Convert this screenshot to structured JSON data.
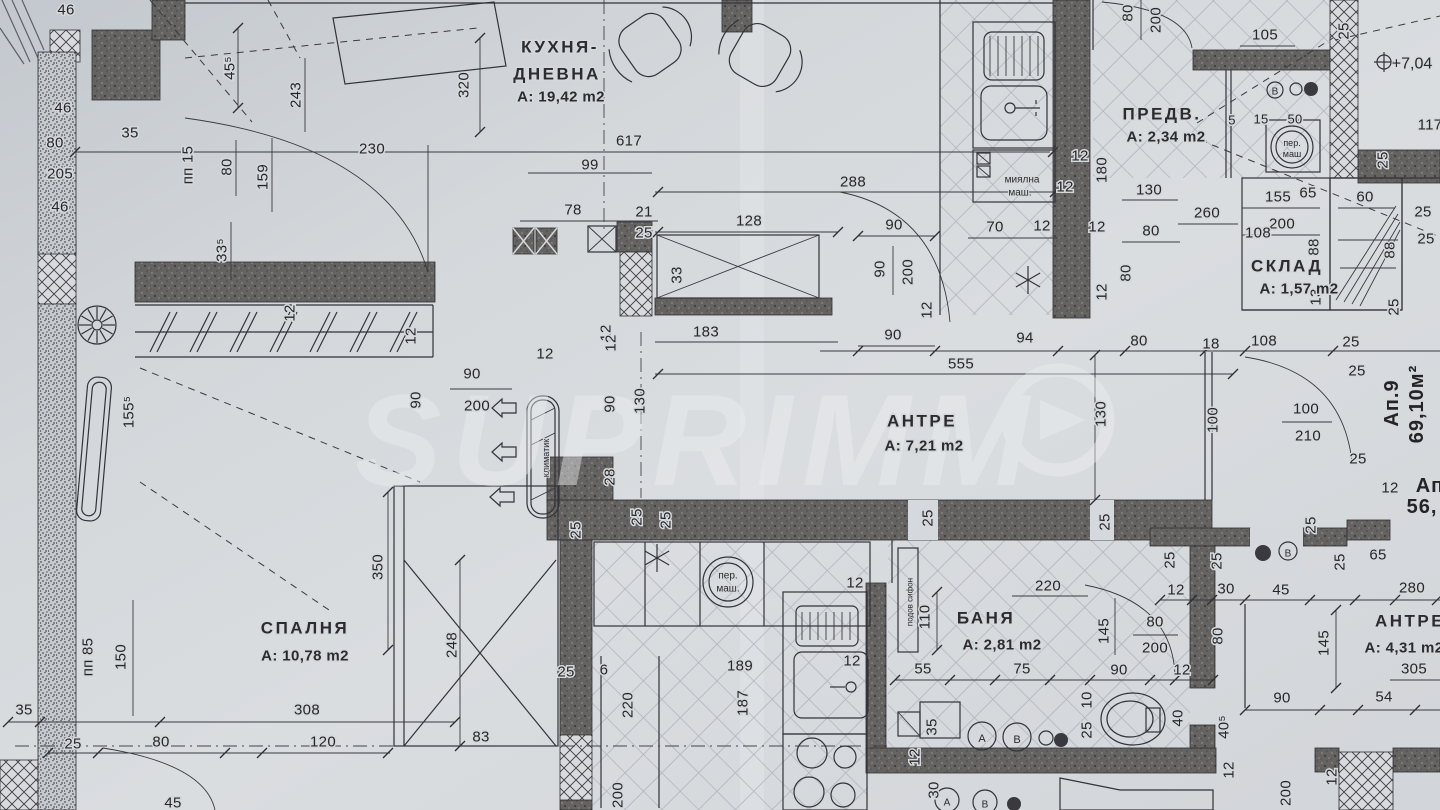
{
  "title": "Floor plan - apartment 9",
  "watermark": {
    "text": "SUPRIMM",
    "logo": "arrow-in-circle"
  },
  "rooms": [
    {
      "id": "kitchen-living",
      "labels": [
        {
          "t": "КУХНЯ-",
          "x": 560,
          "y": 47,
          "cls": "room"
        },
        {
          "t": "ДНЕВНА",
          "x": 557,
          "y": 74,
          "cls": "room"
        },
        {
          "t": "А: 19,42 m2",
          "x": 561,
          "y": 97,
          "cls": "area"
        }
      ]
    },
    {
      "id": "predverie",
      "labels": [
        {
          "t": "ПРЕДВ.",
          "x": 1162,
          "y": 114,
          "cls": "room"
        },
        {
          "t": "А: 2,34 m2",
          "x": 1166,
          "y": 137,
          "cls": "area"
        }
      ]
    },
    {
      "id": "sklad",
      "labels": [
        {
          "t": "СКЛАД",
          "x": 1287,
          "y": 266,
          "cls": "room"
        },
        {
          "t": "А: 1,57 m2",
          "x": 1299,
          "y": 289,
          "cls": "area"
        }
      ]
    },
    {
      "id": "antre-main",
      "labels": [
        {
          "t": "АНТРЕ",
          "x": 922,
          "y": 421,
          "cls": "room"
        },
        {
          "t": "А: 7,21 m2",
          "x": 924,
          "y": 446,
          "cls": "area"
        }
      ]
    },
    {
      "id": "spalnya",
      "labels": [
        {
          "t": "СПАЛНЯ",
          "x": 305,
          "y": 628,
          "cls": "room"
        },
        {
          "t": "А: 10,78 m2",
          "x": 305,
          "y": 656,
          "cls": "area"
        }
      ]
    },
    {
      "id": "banya",
      "labels": [
        {
          "t": "БАНЯ",
          "x": 986,
          "y": 618,
          "cls": "room"
        },
        {
          "t": "А: 2,81 m2",
          "x": 1002,
          "y": 645,
          "cls": "area"
        }
      ]
    },
    {
      "id": "antre-2",
      "labels": [
        {
          "t": "АНТРЕ",
          "x": 1410,
          "y": 621,
          "cls": "room"
        },
        {
          "t": "А: 4,31 m2",
          "x": 1404,
          "y": 648,
          "cls": "area"
        }
      ]
    },
    {
      "id": "apartment-9",
      "labels": [
        {
          "t": "Ап.9",
          "x": 1392,
          "y": 403,
          "r": -90,
          "cls": "big"
        },
        {
          "t": "69,10м²",
          "x": 1417,
          "y": 404,
          "r": -90,
          "cls": "big"
        }
      ]
    },
    {
      "id": "apartment-next",
      "labels": [
        {
          "t": "Ап",
          "x": 1430,
          "y": 486,
          "cls": "big"
        },
        {
          "t": "56,",
          "x": 1422,
          "y": 507,
          "cls": "big"
        }
      ]
    }
  ],
  "annotations": [
    {
      "t": "миялна",
      "x": 1022,
      "y": 180,
      "s": 10
    },
    {
      "t": "маш.",
      "x": 1020,
      "y": 193,
      "s": 10
    },
    {
      "t": "пер.",
      "x": 1292,
      "y": 143,
      "s": 9
    },
    {
      "t": "маш",
      "x": 1292,
      "y": 154,
      "s": 9
    },
    {
      "t": "пер.",
      "x": 728,
      "y": 576,
      "s": 10
    },
    {
      "t": "маш.",
      "x": 728,
      "y": 589,
      "s": 10
    },
    {
      "t": "климатик",
      "x": 546,
      "y": 458,
      "r": -90,
      "s": 9
    },
    {
      "t": "подов сифон",
      "x": 910,
      "y": 602,
      "r": -90,
      "s": 8
    },
    {
      "t": "+7,04",
      "x": 1412,
      "y": 64,
      "s": 16
    },
    {
      "t": "В",
      "x": 1275,
      "y": 92,
      "s": 10
    },
    {
      "t": "В",
      "x": 1288,
      "y": 554,
      "s": 10
    },
    {
      "t": "А",
      "x": 982,
      "y": 739,
      "s": 11
    },
    {
      "t": "В",
      "x": 1017,
      "y": 740,
      "s": 11
    },
    {
      "t": "А",
      "x": 947,
      "y": 803,
      "s": 10
    },
    {
      "t": "В",
      "x": 985,
      "y": 805,
      "s": 10
    }
  ],
  "dims": [
    {
      "t": "46",
      "x": 66,
      "y": 10
    },
    {
      "t": "46",
      "x": 63,
      "y": 108
    },
    {
      "t": "35",
      "x": 130,
      "y": 133
    },
    {
      "t": "80",
      "x": 55,
      "y": 143
    },
    {
      "t": "205",
      "x": 60,
      "y": 174
    },
    {
      "t": "46",
      "x": 60,
      "y": 207
    },
    {
      "t": "45⁵",
      "x": 230,
      "y": 68,
      "r": -90
    },
    {
      "t": "243",
      "x": 296,
      "y": 95,
      "r": -90
    },
    {
      "t": "пп 15",
      "x": 188,
      "y": 165,
      "r": -90
    },
    {
      "t": "80",
      "x": 227,
      "y": 167,
      "r": -90
    },
    {
      "t": "159",
      "x": 263,
      "y": 177,
      "r": -90
    },
    {
      "t": "33⁵",
      "x": 222,
      "y": 250,
      "r": -90
    },
    {
      "t": "230",
      "x": 372,
      "y": 149
    },
    {
      "t": "320",
      "x": 464,
      "y": 85,
      "r": -90
    },
    {
      "t": "617",
      "x": 629,
      "y": 141
    },
    {
      "t": "99",
      "x": 590,
      "y": 165
    },
    {
      "t": "78",
      "x": 573,
      "y": 210
    },
    {
      "t": "21",
      "x": 644,
      "y": 212
    },
    {
      "t": "25",
      "x": 644,
      "y": 233
    },
    {
      "t": "128",
      "x": 749,
      "y": 221
    },
    {
      "t": "288",
      "x": 853,
      "y": 182
    },
    {
      "t": "90",
      "x": 894,
      "y": 225
    },
    {
      "t": "90",
      "x": 880,
      "y": 269,
      "r": -90
    },
    {
      "t": "200",
      "x": 908,
      "y": 272,
      "r": -90
    },
    {
      "t": "12",
      "x": 927,
      "y": 310,
      "r": -90
    },
    {
      "t": "33",
      "x": 677,
      "y": 275,
      "r": -90
    },
    {
      "t": "183",
      "x": 706,
      "y": 332
    },
    {
      "t": "90",
      "x": 893,
      "y": 335
    },
    {
      "t": "12",
      "x": 606,
      "y": 333,
      "r": -90
    },
    {
      "t": "12",
      "x": 545,
      "y": 354
    },
    {
      "t": "12",
      "x": 611,
      "y": 343,
      "r": -90
    },
    {
      "t": "12",
      "x": 411,
      "y": 336,
      "r": -90
    },
    {
      "t": "90",
      "x": 416,
      "y": 400,
      "r": -90
    },
    {
      "t": "90",
      "x": 472,
      "y": 374
    },
    {
      "t": "200",
      "x": 477,
      "y": 406
    },
    {
      "t": "90",
      "x": 610,
      "y": 404,
      "r": -90
    },
    {
      "t": "130",
      "x": 640,
      "y": 401,
      "r": -90
    },
    {
      "t": "28",
      "x": 610,
      "y": 477,
      "r": -90
    },
    {
      "t": "25",
      "x": 637,
      "y": 517,
      "r": -90
    },
    {
      "t": "25",
      "x": 666,
      "y": 520,
      "r": -90
    },
    {
      "t": "155⁵",
      "x": 129,
      "y": 412,
      "r": -90
    },
    {
      "t": "12",
      "x": 290,
      "y": 313,
      "r": -90
    },
    {
      "t": "12",
      "x": 1080,
      "y": 156
    },
    {
      "t": "180",
      "x": 1102,
      "y": 170,
      "r": -90
    },
    {
      "t": "12",
      "x": 1065,
      "y": 187
    },
    {
      "t": "70",
      "x": 995,
      "y": 227
    },
    {
      "t": "12",
      "x": 1042,
      "y": 226
    },
    {
      "t": "12",
      "x": 1097,
      "y": 227
    },
    {
      "t": "80",
      "x": 1126,
      "y": 273,
      "r": -90
    },
    {
      "t": "12",
      "x": 1102,
      "y": 292,
      "r": -90
    },
    {
      "t": "80",
      "x": 1128,
      "y": 13,
      "r": -90
    },
    {
      "t": "200",
      "x": 1156,
      "y": 20,
      "r": -90
    },
    {
      "t": "105",
      "x": 1265,
      "y": 35
    },
    {
      "t": "25",
      "x": 1344,
      "y": 31,
      "r": -90
    },
    {
      "t": "5",
      "x": 1232,
      "y": 120,
      "s": 13
    },
    {
      "t": "15",
      "x": 1261,
      "y": 119,
      "s": 13
    },
    {
      "t": "50",
      "x": 1295,
      "y": 119,
      "s": 13
    },
    {
      "t": "130",
      "x": 1149,
      "y": 190
    },
    {
      "t": "260",
      "x": 1207,
      "y": 213
    },
    {
      "t": "80",
      "x": 1151,
      "y": 231
    },
    {
      "t": "155",
      "x": 1278,
      "y": 197
    },
    {
      "t": "65",
      "x": 1308,
      "y": 193
    },
    {
      "t": "200",
      "x": 1282,
      "y": 224
    },
    {
      "t": "108",
      "x": 1258,
      "y": 233
    },
    {
      "t": "60",
      "x": 1365,
      "y": 197
    },
    {
      "t": "88",
      "x": 1390,
      "y": 250,
      "r": -90
    },
    {
      "t": "88",
      "x": 1314,
      "y": 247,
      "r": -90
    },
    {
      "t": "13",
      "x": 1316,
      "y": 297,
      "r": -90
    },
    {
      "t": "25",
      "x": 1383,
      "y": 160,
      "r": -90
    },
    {
      "t": "25",
      "x": 1423,
      "y": 212
    },
    {
      "t": "25",
      "x": 1426,
      "y": 239
    },
    {
      "t": "25",
      "x": 1394,
      "y": 307,
      "r": -90
    },
    {
      "t": "117",
      "x": 1430,
      "y": 125
    },
    {
      "t": "94",
      "x": 1025,
      "y": 338
    },
    {
      "t": "80",
      "x": 1139,
      "y": 341
    },
    {
      "t": "18",
      "x": 1211,
      "y": 344
    },
    {
      "t": "108",
      "x": 1264,
      "y": 341
    },
    {
      "t": "555",
      "x": 961,
      "y": 364
    },
    {
      "t": "130",
      "x": 1101,
      "y": 414,
      "r": -90
    },
    {
      "t": "100",
      "x": 1213,
      "y": 420,
      "r": -90
    },
    {
      "t": "25",
      "x": 1351,
      "y": 342
    },
    {
      "t": "25",
      "x": 1357,
      "y": 371
    },
    {
      "t": "100",
      "x": 1306,
      "y": 409
    },
    {
      "t": "210",
      "x": 1308,
      "y": 436
    },
    {
      "t": "25",
      "x": 1358,
      "y": 459
    },
    {
      "t": "12",
      "x": 1390,
      "y": 488
    },
    {
      "t": "25",
      "x": 1311,
      "y": 525,
      "r": -90
    },
    {
      "t": "25",
      "x": 928,
      "y": 518,
      "r": -90
    },
    {
      "t": "25",
      "x": 1105,
      "y": 522,
      "r": -90
    },
    {
      "t": "350",
      "x": 378,
      "y": 567,
      "r": -90
    },
    {
      "t": "248",
      "x": 452,
      "y": 645,
      "r": -90
    },
    {
      "t": "150",
      "x": 121,
      "y": 657,
      "r": -90
    },
    {
      "t": "пп 85",
      "x": 88,
      "y": 657,
      "r": -90
    },
    {
      "t": "35",
      "x": 24,
      "y": 710
    },
    {
      "t": "25",
      "x": 73,
      "y": 744
    },
    {
      "t": "80",
      "x": 161,
      "y": 742
    },
    {
      "t": "308",
      "x": 307,
      "y": 710
    },
    {
      "t": "120",
      "x": 323,
      "y": 742
    },
    {
      "t": "83",
      "x": 481,
      "y": 737
    },
    {
      "t": "45",
      "x": 173,
      "y": 803
    },
    {
      "t": "25",
      "x": 576,
      "y": 530,
      "r": -90
    },
    {
      "t": "25",
      "x": 566,
      "y": 672
    },
    {
      "t": "6",
      "x": 604,
      "y": 670
    },
    {
      "t": "189",
      "x": 740,
      "y": 666
    },
    {
      "t": "187",
      "x": 743,
      "y": 703,
      "r": -90
    },
    {
      "t": "220",
      "x": 628,
      "y": 705,
      "r": -90
    },
    {
      "t": "12",
      "x": 852,
      "y": 661
    },
    {
      "t": "12",
      "x": 855,
      "y": 583
    },
    {
      "t": "200",
      "x": 618,
      "y": 795,
      "r": -90
    },
    {
      "t": "220",
      "x": 1048,
      "y": 586
    },
    {
      "t": "110",
      "x": 925,
      "y": 617,
      "r": -90
    },
    {
      "t": "55",
      "x": 923,
      "y": 669
    },
    {
      "t": "75",
      "x": 1022,
      "y": 669
    },
    {
      "t": "90",
      "x": 1119,
      "y": 670
    },
    {
      "t": "145",
      "x": 1104,
      "y": 631,
      "r": -90
    },
    {
      "t": "80",
      "x": 1155,
      "y": 622
    },
    {
      "t": "200",
      "x": 1155,
      "y": 648
    },
    {
      "t": "12",
      "x": 1182,
      "y": 670
    },
    {
      "t": "80",
      "x": 1218,
      "y": 636,
      "r": -90
    },
    {
      "t": "10",
      "x": 1087,
      "y": 700,
      "r": -90
    },
    {
      "t": "25",
      "x": 1087,
      "y": 730,
      "r": -90
    },
    {
      "t": "40",
      "x": 1178,
      "y": 718,
      "r": -90
    },
    {
      "t": "35",
      "x": 932,
      "y": 727,
      "r": -90
    },
    {
      "t": "30",
      "x": 934,
      "y": 790,
      "r": -90
    },
    {
      "t": "12",
      "x": 915,
      "y": 757,
      "r": -90
    },
    {
      "t": "25",
      "x": 1170,
      "y": 560,
      "r": -90
    },
    {
      "t": "12",
      "x": 1176,
      "y": 590
    },
    {
      "t": "25",
      "x": 1217,
      "y": 561,
      "r": -90
    },
    {
      "t": "30",
      "x": 1226,
      "y": 589
    },
    {
      "t": "45",
      "x": 1281,
      "y": 590
    },
    {
      "t": "25",
      "x": 1340,
      "y": 562,
      "r": -90
    },
    {
      "t": "65",
      "x": 1378,
      "y": 555
    },
    {
      "t": "280",
      "x": 1412,
      "y": 588
    },
    {
      "t": "145",
      "x": 1324,
      "y": 643,
      "r": -90
    },
    {
      "t": "90",
      "x": 1282,
      "y": 698
    },
    {
      "t": "54",
      "x": 1384,
      "y": 697
    },
    {
      "t": "305",
      "x": 1414,
      "y": 669
    },
    {
      "t": "40⁵",
      "x": 1224,
      "y": 727,
      "r": -90
    },
    {
      "t": "12",
      "x": 1229,
      "y": 770,
      "r": -90
    },
    {
      "t": "12",
      "x": 1332,
      "y": 777,
      "r": -90
    },
    {
      "t": "200",
      "x": 1286,
      "y": 793,
      "r": -90
    }
  ]
}
